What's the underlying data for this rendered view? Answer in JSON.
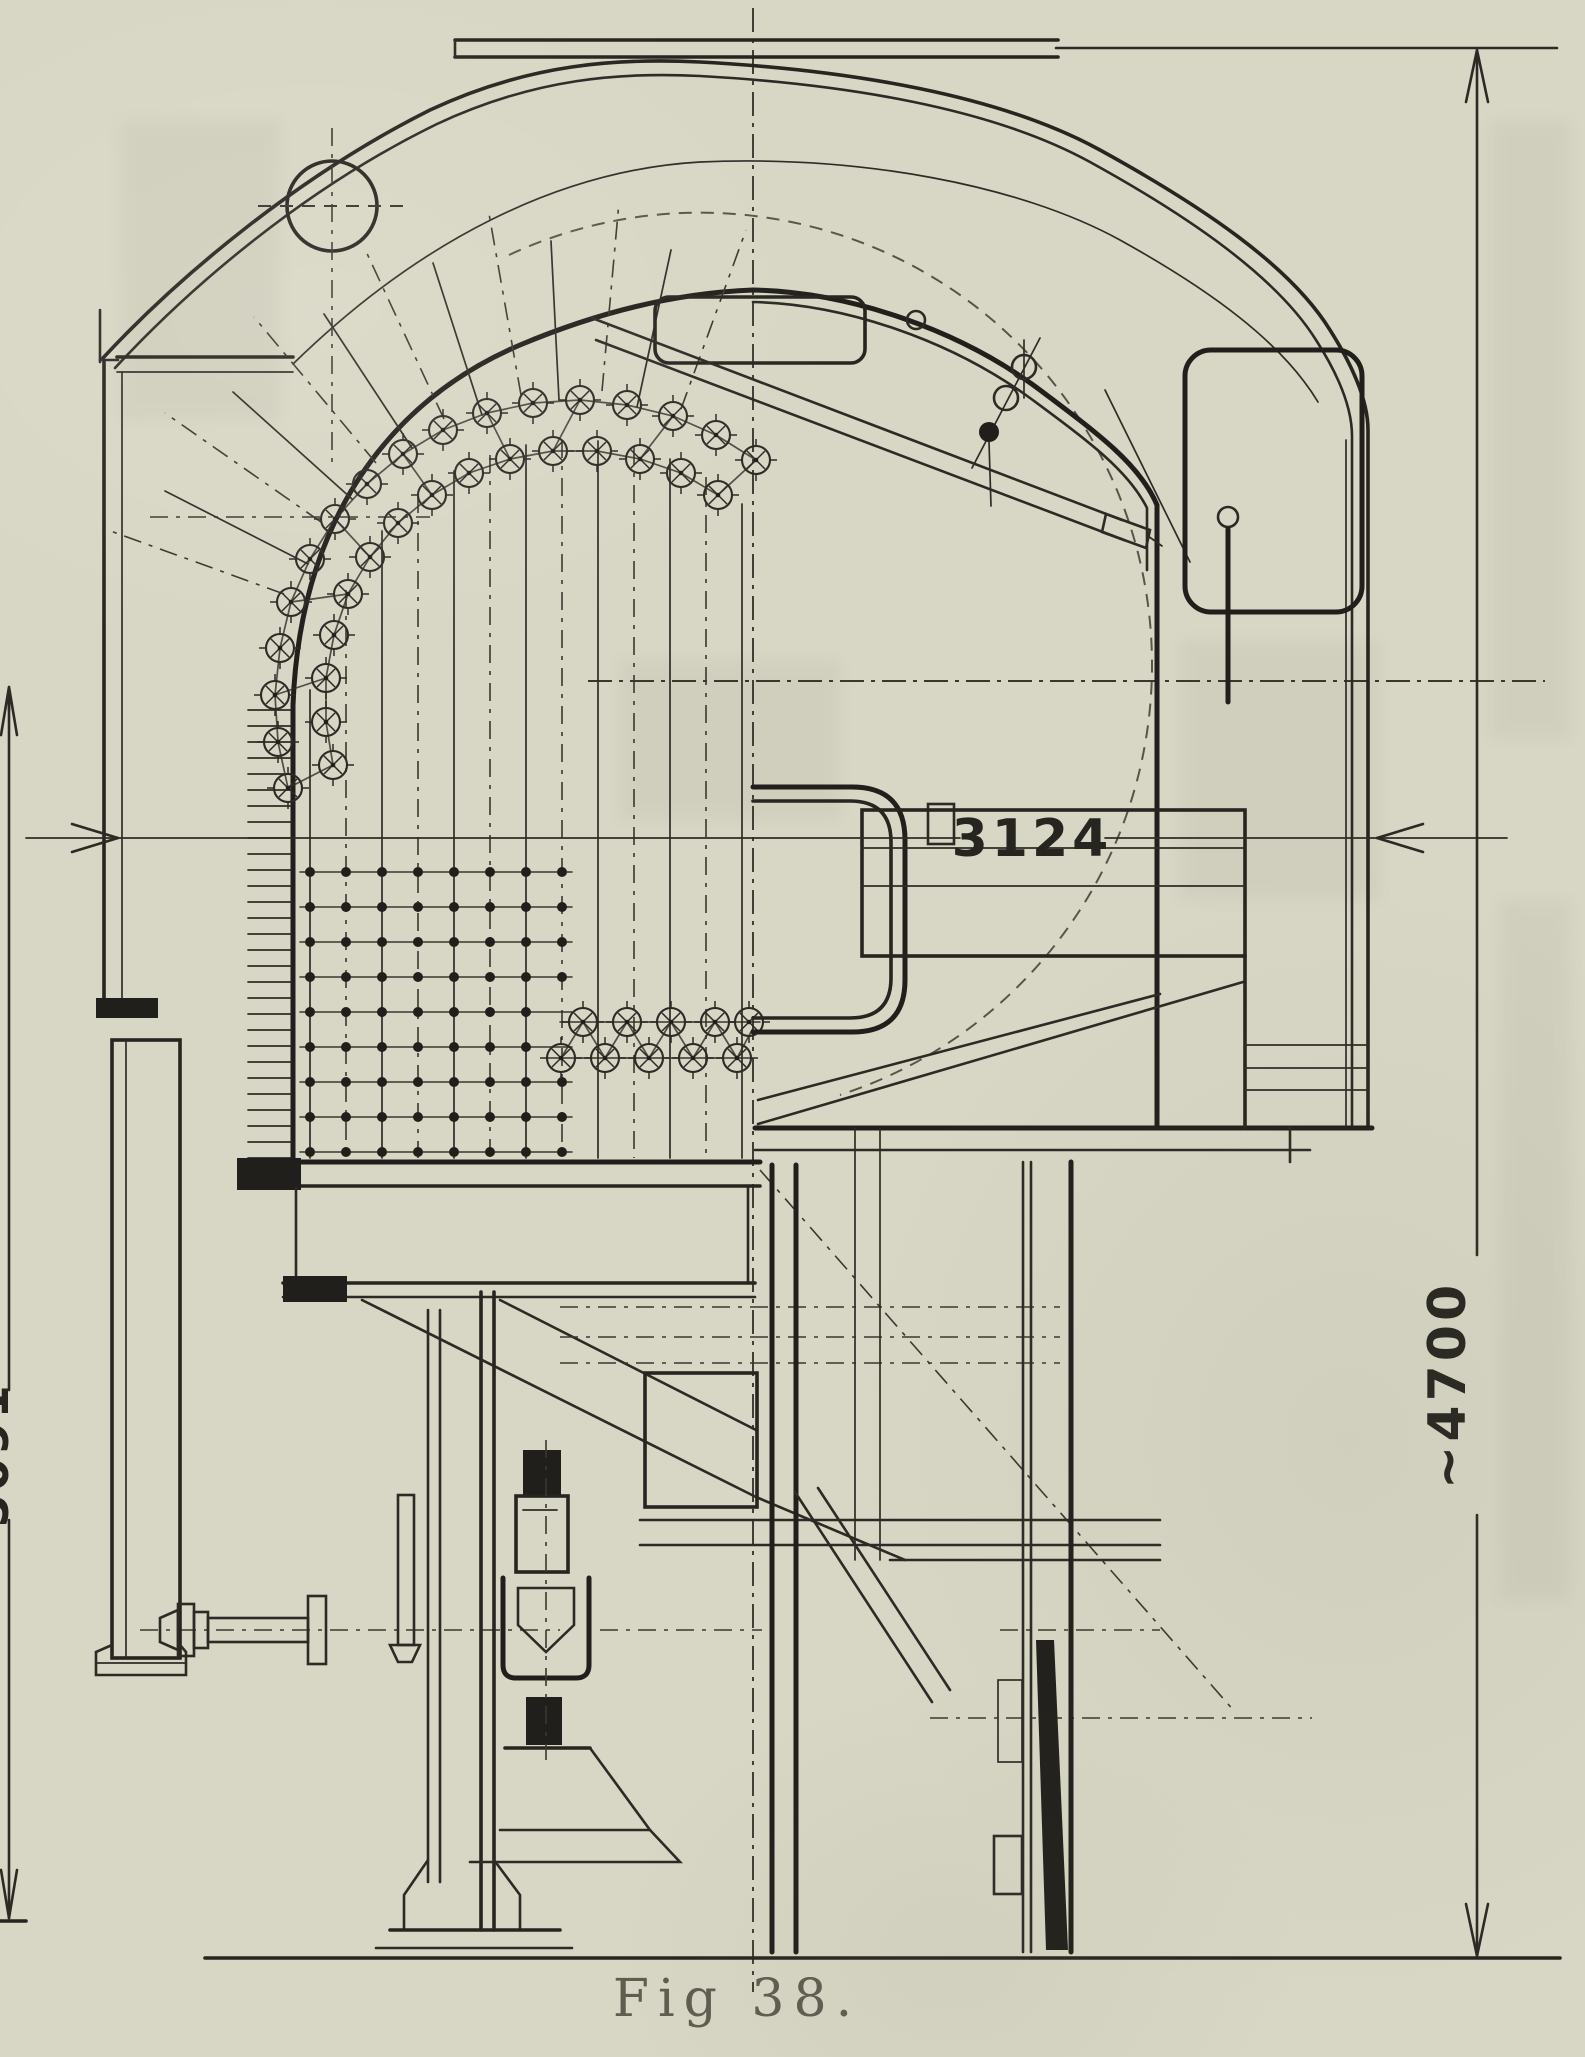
{
  "page": {
    "type": "Scanned book page: locomotive boiler and cab cross-section drawing",
    "paper_color": "#d8d6c4",
    "ink_color": "#2b2a25"
  },
  "figure": {
    "caption": "Fig 38.",
    "dimensions": {
      "width_label": "3124",
      "height_right_label": "~4700",
      "height_left_label": "5091"
    }
  }
}
